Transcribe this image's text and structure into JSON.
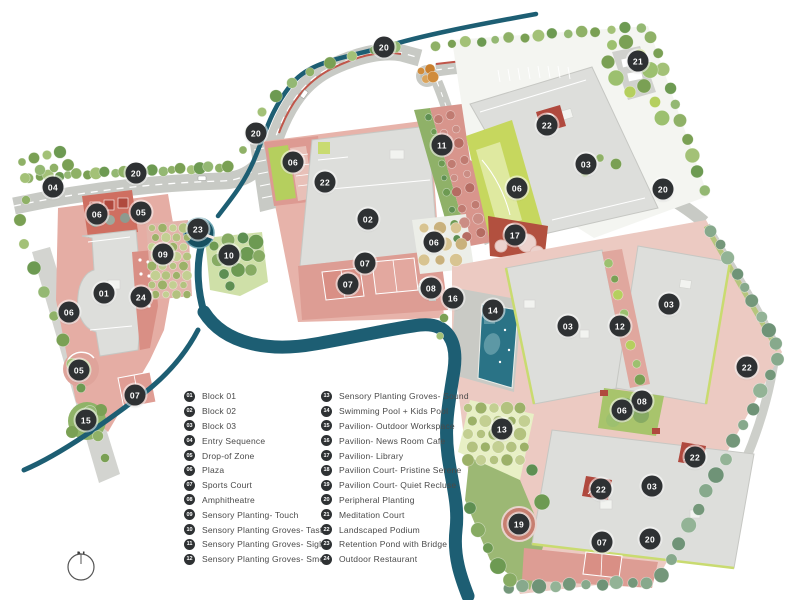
{
  "title": "Landscape Master Site Plan",
  "compass": {
    "north_label": "N"
  },
  "colors": {
    "marker_bg": "#2e3133",
    "marker_text": "#ffffff",
    "legend_text": "#4a4a4a",
    "river": "#1d5e73",
    "pond": "#175061",
    "pool": "#2a7386",
    "building": "#dddedb",
    "road": "#c8cac5",
    "hardscape_pink": "#e0a096",
    "lawn_green": "#c6d75e",
    "podium_red": "#b0493e"
  },
  "legend": {
    "columns": [
      [
        {
          "num": "01",
          "label": "Block 01"
        },
        {
          "num": "02",
          "label": "Block 02"
        },
        {
          "num": "03",
          "label": "Block 03"
        },
        {
          "num": "04",
          "label": "Entry Sequence"
        },
        {
          "num": "05",
          "label": "Drop-of Zone"
        },
        {
          "num": "06",
          "label": "Plaza"
        },
        {
          "num": "07",
          "label": "Sports Court"
        },
        {
          "num": "08",
          "label": "Amphitheatre"
        },
        {
          "num": "09",
          "label": "Sensory Planting- Touch"
        },
        {
          "num": "10",
          "label": "Sensory Planting Groves- Taste"
        },
        {
          "num": "11",
          "label": "Sensory Planting Groves- Sight"
        },
        {
          "num": "12",
          "label": "Sensory Planting Groves- Smell"
        }
      ],
      [
        {
          "num": "13",
          "label": "Sensory Planting Groves- Sound"
        },
        {
          "num": "14",
          "label": "Swimming Pool + Kids Pool"
        },
        {
          "num": "15",
          "label": "Pavilion- Outdoor Workspace"
        },
        {
          "num": "16",
          "label": "Pavilion- News Room Cafe"
        },
        {
          "num": "17",
          "label": "Pavilion- Library"
        },
        {
          "num": "18",
          "label": "Pavilion Court- Pristine Serene"
        },
        {
          "num": "19",
          "label": "Pavilion Court- Quiet Recluse"
        },
        {
          "num": "20",
          "label": "Peripheral Planting"
        },
        {
          "num": "21",
          "label": "Meditation Court"
        },
        {
          "num": "22",
          "label": "Landscaped Podium"
        },
        {
          "num": "23",
          "label": "Retention Pond with Bridge"
        },
        {
          "num": "24",
          "label": "Outdoor Restaurant"
        }
      ]
    ]
  },
  "map": {
    "markers": [
      {
        "label": "20",
        "x": 384,
        "y": 47
      },
      {
        "label": "21",
        "x": 638,
        "y": 61
      },
      {
        "label": "22",
        "x": 547,
        "y": 125
      },
      {
        "label": "20",
        "x": 256,
        "y": 133
      },
      {
        "label": "11",
        "x": 442,
        "y": 145
      },
      {
        "label": "06",
        "x": 293,
        "y": 162
      },
      {
        "label": "03",
        "x": 586,
        "y": 164
      },
      {
        "label": "20",
        "x": 136,
        "y": 173
      },
      {
        "label": "22",
        "x": 325,
        "y": 182
      },
      {
        "label": "04",
        "x": 53,
        "y": 187
      },
      {
        "label": "06",
        "x": 517,
        "y": 188
      },
      {
        "label": "20",
        "x": 663,
        "y": 189
      },
      {
        "label": "05",
        "x": 141,
        "y": 212
      },
      {
        "label": "06",
        "x": 97,
        "y": 214
      },
      {
        "label": "02",
        "x": 368,
        "y": 219
      },
      {
        "label": "23",
        "x": 198,
        "y": 229
      },
      {
        "label": "17",
        "x": 515,
        "y": 235
      },
      {
        "label": "06",
        "x": 434,
        "y": 242
      },
      {
        "label": "09",
        "x": 163,
        "y": 254
      },
      {
        "label": "10",
        "x": 229,
        "y": 255
      },
      {
        "label": "07",
        "x": 365,
        "y": 263
      },
      {
        "label": "07",
        "x": 348,
        "y": 284
      },
      {
        "label": "08",
        "x": 431,
        "y": 288
      },
      {
        "label": "01",
        "x": 104,
        "y": 293
      },
      {
        "label": "24",
        "x": 141,
        "y": 297
      },
      {
        "label": "16",
        "x": 453,
        "y": 298
      },
      {
        "label": "03",
        "x": 669,
        "y": 304
      },
      {
        "label": "14",
        "x": 493,
        "y": 310
      },
      {
        "label": "06",
        "x": 69,
        "y": 312
      },
      {
        "label": "03",
        "x": 568,
        "y": 326
      },
      {
        "label": "12",
        "x": 620,
        "y": 326
      },
      {
        "label": "22",
        "x": 747,
        "y": 367
      },
      {
        "label": "05",
        "x": 79,
        "y": 370
      },
      {
        "label": "07",
        "x": 135,
        "y": 395
      },
      {
        "label": "08",
        "x": 642,
        "y": 401
      },
      {
        "label": "06",
        "x": 622,
        "y": 410
      },
      {
        "label": "15",
        "x": 86,
        "y": 420
      },
      {
        "label": "13",
        "x": 502,
        "y": 429
      },
      {
        "label": "22",
        "x": 695,
        "y": 457
      },
      {
        "label": "03",
        "x": 652,
        "y": 486
      },
      {
        "label": "22",
        "x": 601,
        "y": 489
      },
      {
        "label": "19",
        "x": 519,
        "y": 524
      },
      {
        "label": "20",
        "x": 650,
        "y": 539
      },
      {
        "label": "07",
        "x": 602,
        "y": 542
      }
    ]
  }
}
